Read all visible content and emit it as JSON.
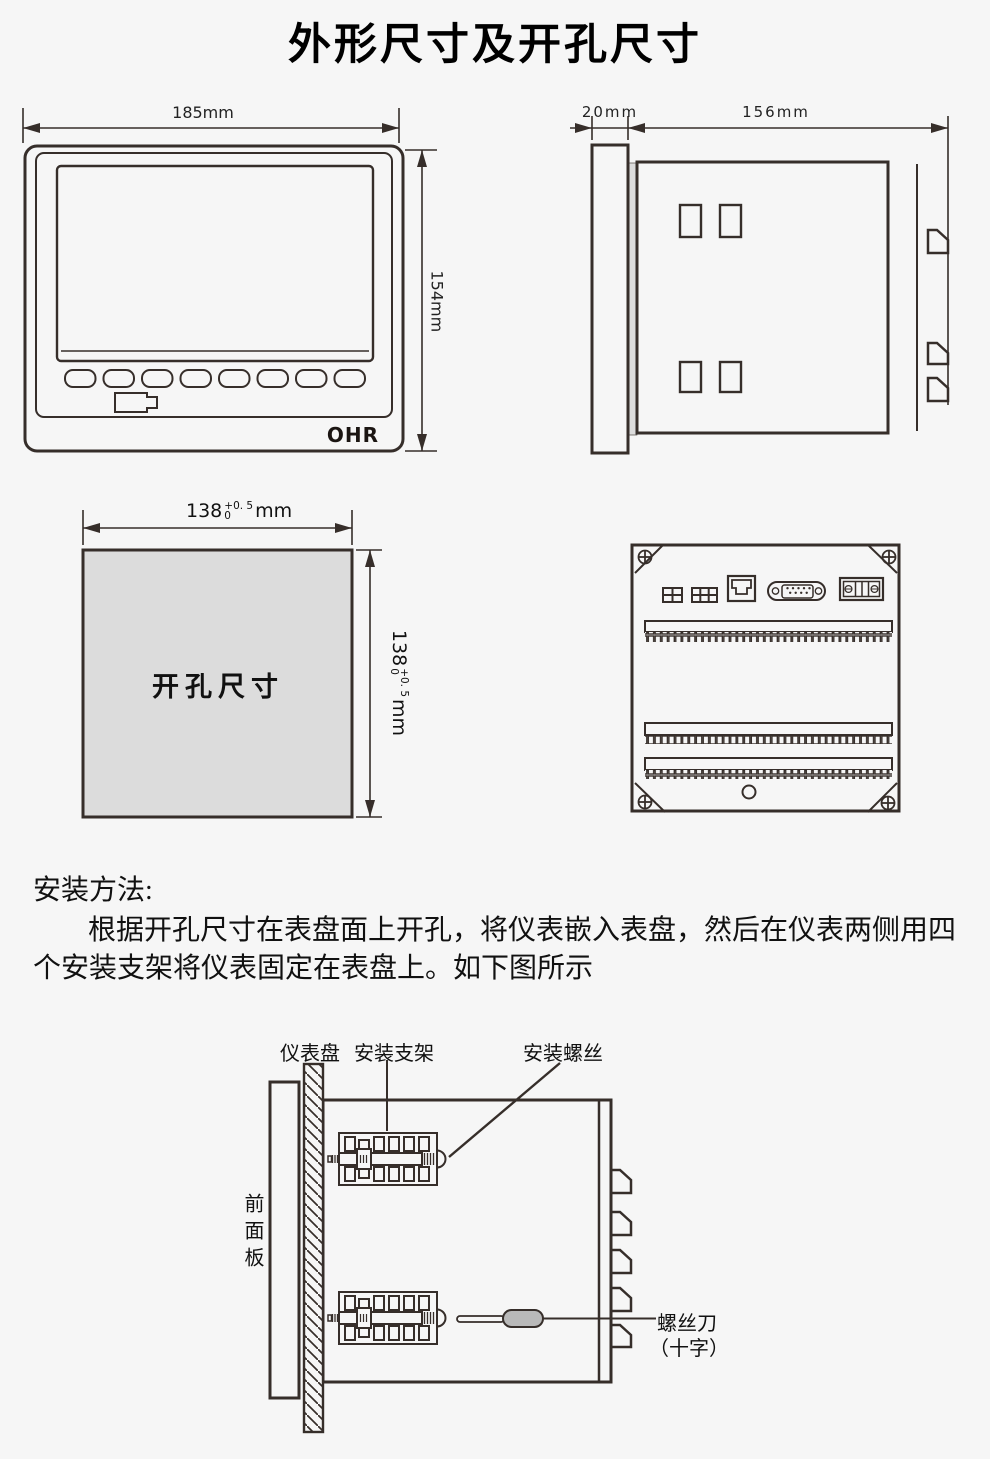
{
  "page": {
    "title": "外形尺寸及开孔尺寸"
  },
  "front_view": {
    "width_label": "185mm",
    "height_label": "154mm",
    "brand": "OHR"
  },
  "side_view": {
    "depth_label": "20mm",
    "length_label": "156mm"
  },
  "cutout": {
    "label": "开孔尺寸",
    "h_dim": {
      "base": "138",
      "sup": "+0. 5",
      "sub": "0",
      "unit": "mm"
    },
    "v_dim": {
      "base": "138",
      "sup": "+0. 5",
      "sub": "0",
      "unit": "mm"
    }
  },
  "install_method": {
    "heading": "安装方法:",
    "line1": "根据开孔尺寸在表盘面上开孔，将仪表嵌入表盘，然后在仪表两侧用四",
    "line2": "个安装支架将仪表固定在表盘上。如下图所示"
  },
  "install_diagram": {
    "panel_label": "仪表盘",
    "bracket_label": "安装支架",
    "screw_label": "安装螺丝",
    "front_panel_label": "前面板",
    "screwdriver_label": "螺丝刀",
    "screwdriver_label2": "（十字）"
  }
}
